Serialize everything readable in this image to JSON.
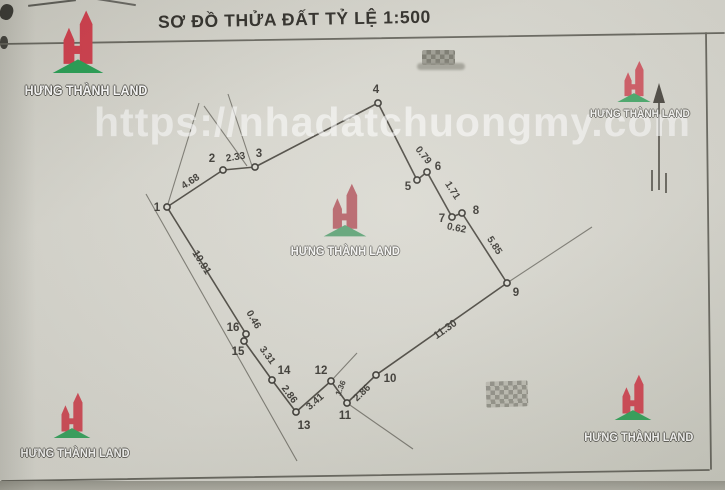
{
  "title": "SƠ ĐỒ THỬA ĐẤT TỶ LỆ 1:500",
  "watermark": {
    "url": "https://nhadatchuongmy.com",
    "brand": "HƯNG THÀNH LAND"
  },
  "colors": {
    "paper": "#d8d7cf",
    "ink": "#403e39",
    "line": "#514e47",
    "extension": "#6f6d65",
    "frame": "#6b6a62",
    "brand_red": "#d2404e",
    "brand_green": "#2aa156"
  },
  "diagram": {
    "frame": [
      [
        0,
        44,
        724,
        33
      ],
      [
        706,
        33,
        711,
        469
      ],
      [
        2,
        481,
        709,
        470
      ]
    ],
    "vertices": [
      {
        "n": "1",
        "x": 167,
        "y": 207,
        "lx": 157,
        "ly": 211
      },
      {
        "n": "2",
        "x": 223,
        "y": 170,
        "lx": 212,
        "ly": 162
      },
      {
        "n": "3",
        "x": 255,
        "y": 167,
        "lx": 259,
        "ly": 157
      },
      {
        "n": "4",
        "x": 378,
        "y": 103,
        "lx": 376,
        "ly": 93
      },
      {
        "n": "5",
        "x": 417,
        "y": 180,
        "lx": 408,
        "ly": 190
      },
      {
        "n": "6",
        "x": 427,
        "y": 172,
        "lx": 438,
        "ly": 170
      },
      {
        "n": "7",
        "x": 452,
        "y": 217,
        "lx": 442,
        "ly": 222
      },
      {
        "n": "8",
        "x": 462,
        "y": 213,
        "lx": 476,
        "ly": 214
      },
      {
        "n": "9",
        "x": 507,
        "y": 283,
        "lx": 516,
        "ly": 296
      },
      {
        "n": "10",
        "x": 376,
        "y": 375,
        "lx": 390,
        "ly": 382
      },
      {
        "n": "11",
        "x": 347,
        "y": 403,
        "lx": 345,
        "ly": 419
      },
      {
        "n": "12",
        "x": 331,
        "y": 381,
        "lx": 321,
        "ly": 374
      },
      {
        "n": "13",
        "x": 296,
        "y": 412,
        "lx": 304,
        "ly": 429
      },
      {
        "n": "14",
        "x": 272,
        "y": 380,
        "lx": 284,
        "ly": 374
      },
      {
        "n": "15",
        "x": 244,
        "y": 341,
        "lx": 238,
        "ly": 355
      },
      {
        "n": "16",
        "x": 246,
        "y": 334,
        "lx": 233,
        "ly": 331
      }
    ],
    "measurements": [
      {
        "text": "4.68",
        "x": 192,
        "y": 184,
        "rot": -33
      },
      {
        "text": "2.33",
        "x": 236,
        "y": 160,
        "rot": -9
      },
      {
        "text": "0.79",
        "x": 421,
        "y": 157,
        "rot": 52
      },
      {
        "text": "1.71",
        "x": 450,
        "y": 192,
        "rot": 57
      },
      {
        "text": "0.62",
        "x": 456,
        "y": 231,
        "rot": 11
      },
      {
        "text": "5.85",
        "x": 492,
        "y": 247,
        "rot": 57
      },
      {
        "text": "11.30",
        "x": 447,
        "y": 332,
        "rot": -35,
        "size": 10.5
      },
      {
        "text": "2.86",
        "x": 364,
        "y": 395,
        "rot": -44
      },
      {
        "text": "1.36",
        "x": 343,
        "y": 389,
        "rot": -68,
        "size": 8
      },
      {
        "text": "3.41",
        "x": 317,
        "y": 404,
        "rot": -41
      },
      {
        "text": "2.86",
        "x": 287,
        "y": 396,
        "rot": 54
      },
      {
        "text": "3.31",
        "x": 265,
        "y": 357,
        "rot": 54
      },
      {
        "text": "0.46",
        "x": 251,
        "y": 321,
        "rot": 60
      },
      {
        "text": "10.91",
        "x": 199,
        "y": 264,
        "rot": 58,
        "size": 10.5
      }
    ],
    "extensions": [
      [
        199,
        103,
        167,
        207
      ],
      [
        204,
        106,
        247,
        166
      ],
      [
        228,
        94,
        252,
        166
      ],
      [
        507,
        283,
        592,
        227
      ],
      [
        347,
        403,
        413,
        449
      ],
      [
        331,
        381,
        357,
        353
      ],
      [
        146,
        194,
        297,
        461
      ]
    ],
    "north_arrow": {
      "shaft": [
        659,
        190,
        659,
        92
      ],
      "head": "659,83 653,103 665,103",
      "ticks": [
        [
          652,
          170,
          652,
          191
        ],
        [
          666,
          173,
          666,
          193
        ]
      ]
    }
  }
}
